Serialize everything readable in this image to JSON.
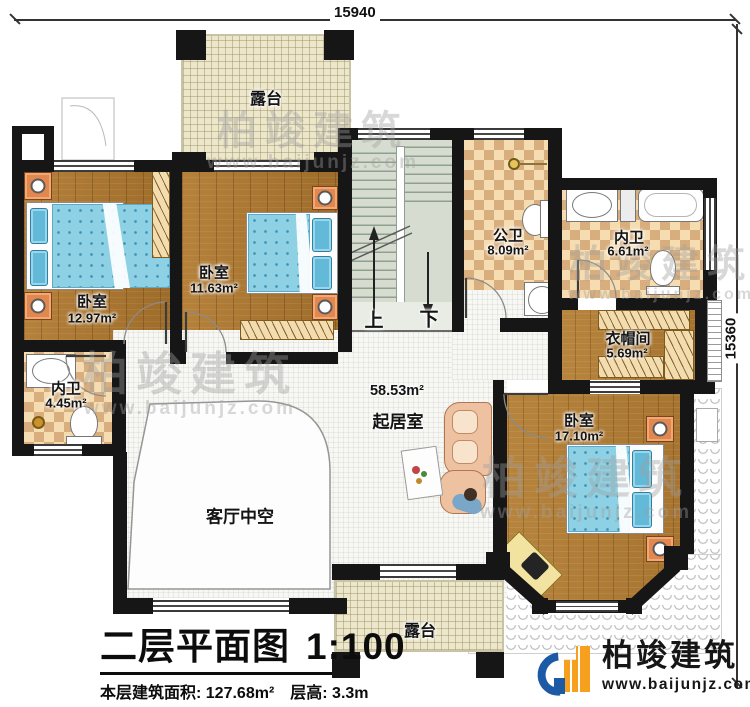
{
  "dimensions": {
    "top": "15940",
    "right": "15360"
  },
  "rooms": {
    "terrace_top": {
      "name": "露台"
    },
    "bedroom_left": {
      "name": "卧室",
      "area": "12.97m²"
    },
    "bedroom_mid": {
      "name": "卧室",
      "area": "11.63m²"
    },
    "bath_left": {
      "name": "内卫",
      "area": "4.45m²"
    },
    "public_bath": {
      "name": "公卫",
      "area": "8.09m²"
    },
    "bath_right": {
      "name": "内卫",
      "area": "6.61m²"
    },
    "cloakroom": {
      "name": "衣帽间",
      "area": "5.69m²"
    },
    "living": {
      "name": "起居室",
      "area": "58.53m²"
    },
    "void": {
      "name": "客厅中空"
    },
    "bedroom_master": {
      "name": "卧室",
      "area": "17.10m²"
    },
    "terrace_bottom": {
      "name": "露台"
    }
  },
  "stairs": {
    "up": "上",
    "down": "下"
  },
  "title_block": {
    "title": "二层平面图",
    "scale": "1:100",
    "floor_area": "本层建筑面积: 127.68m²",
    "floor_height": "层高: 3.3m"
  },
  "brand": {
    "name": "柏竣建筑",
    "url": "www.baijunjz.com"
  },
  "watermark": {
    "name": "柏竣建筑",
    "url": "www.baijunjz.com"
  },
  "colors": {
    "wall": "#161616",
    "wood": "#a9772f",
    "tile_light": "#f6ddb1",
    "tile_dark": "#d8ae7e",
    "terrace": "#ece6cb",
    "stair_floor": "#d6ddd0",
    "bed_blue": "#8ed1e4",
    "nightstand_orange": "#e2884f",
    "logo_blue": "#1d5aa6",
    "logo_orange": "#f6a01e"
  }
}
